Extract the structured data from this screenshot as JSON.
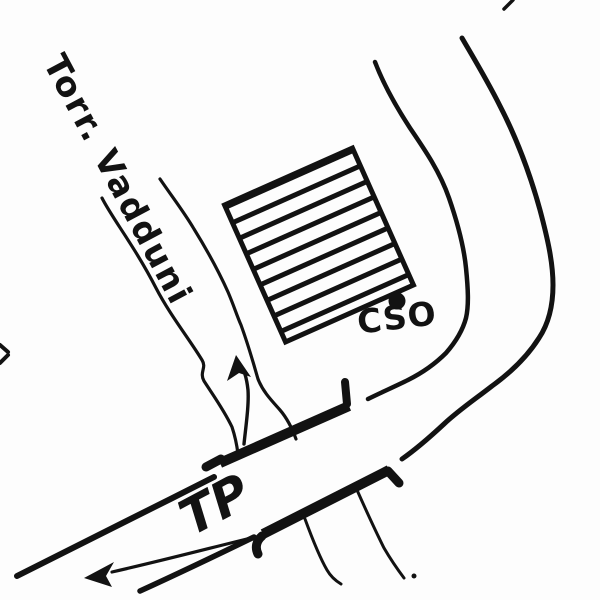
{
  "labels": {
    "stream": "Torr. Vadduni",
    "road": "TP",
    "site": "CSO"
  },
  "colors": {
    "ink": "#121212",
    "paper": "#fdfdfd"
  }
}
